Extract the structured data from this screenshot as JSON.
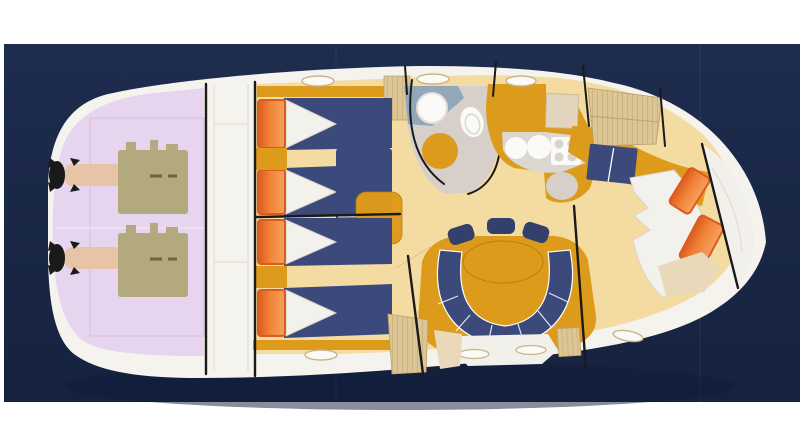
{
  "image": {
    "kind": "yacht-deck-plan",
    "description": "Top-down accommodation deck plan of a motor yacht, stern at left and bow at right, on a dark navy photo background"
  },
  "colors": {
    "page": "#ffffff",
    "photoNavyTop": "#1e2c4e",
    "photoNavyBottom": "#15223f",
    "shadow": "#101c37",
    "hull": "#f5f3ee",
    "hullSeam": "#ddd9cf",
    "engineRoom": "#e7d4ee",
    "engineRoomLine": "#d8c4e2",
    "engine": "#b2a97d",
    "engineDark": "#6d6548",
    "shaft": "#e8c4a6",
    "floor": "#f4dba2",
    "floorLine": "#d9b576",
    "gold": "#dd9b1b",
    "goldDark": "#b97f10",
    "orange": "#f08338",
    "orangeDark": "#dd5a1e",
    "navy": "#3b4a7a",
    "navyDark": "#33406c",
    "bedding": "#f3f1ec",
    "beddingShade": "#d9d4c8",
    "headFloor": "#93a7bb",
    "grey": "#d6cfca",
    "counter": "#ddd7d1",
    "fixture": "#fafaf8",
    "tan": "#dcc697",
    "tanGrain": "#bfa266",
    "beigeWedge": "#ead8ba",
    "cabinet": "#e3d4bd",
    "line": "#1a1a1a",
    "porthole": "#fbfaf6",
    "portholeRing": "#c9b48a",
    "deckWhite": "#f2f0ea"
  },
  "regions": [
    {
      "name": "engine-room",
      "label": "engine room with twin engines"
    },
    {
      "name": "aft-bulkhead",
      "label": "aft bulkhead band"
    },
    {
      "name": "guest-cabin-aft-port",
      "label": "twin guest cabin (upper)"
    },
    {
      "name": "guest-cabin-aft-starboard",
      "label": "twin guest cabin (lower)"
    },
    {
      "name": "head",
      "label": "head compartment with sink and toilet"
    },
    {
      "name": "galley",
      "label": "galley with twin sinks and stove"
    },
    {
      "name": "wardrobe",
      "label": "wood wardrobe panels"
    },
    {
      "name": "v-berth",
      "label": "forward V-berth cabin"
    },
    {
      "name": "dinette",
      "label": "U-shaped dinette settee with oval table"
    },
    {
      "name": "bow-deck",
      "label": "bow deck / anchor locker"
    },
    {
      "name": "portholes",
      "label": "hull portholes"
    }
  ]
}
